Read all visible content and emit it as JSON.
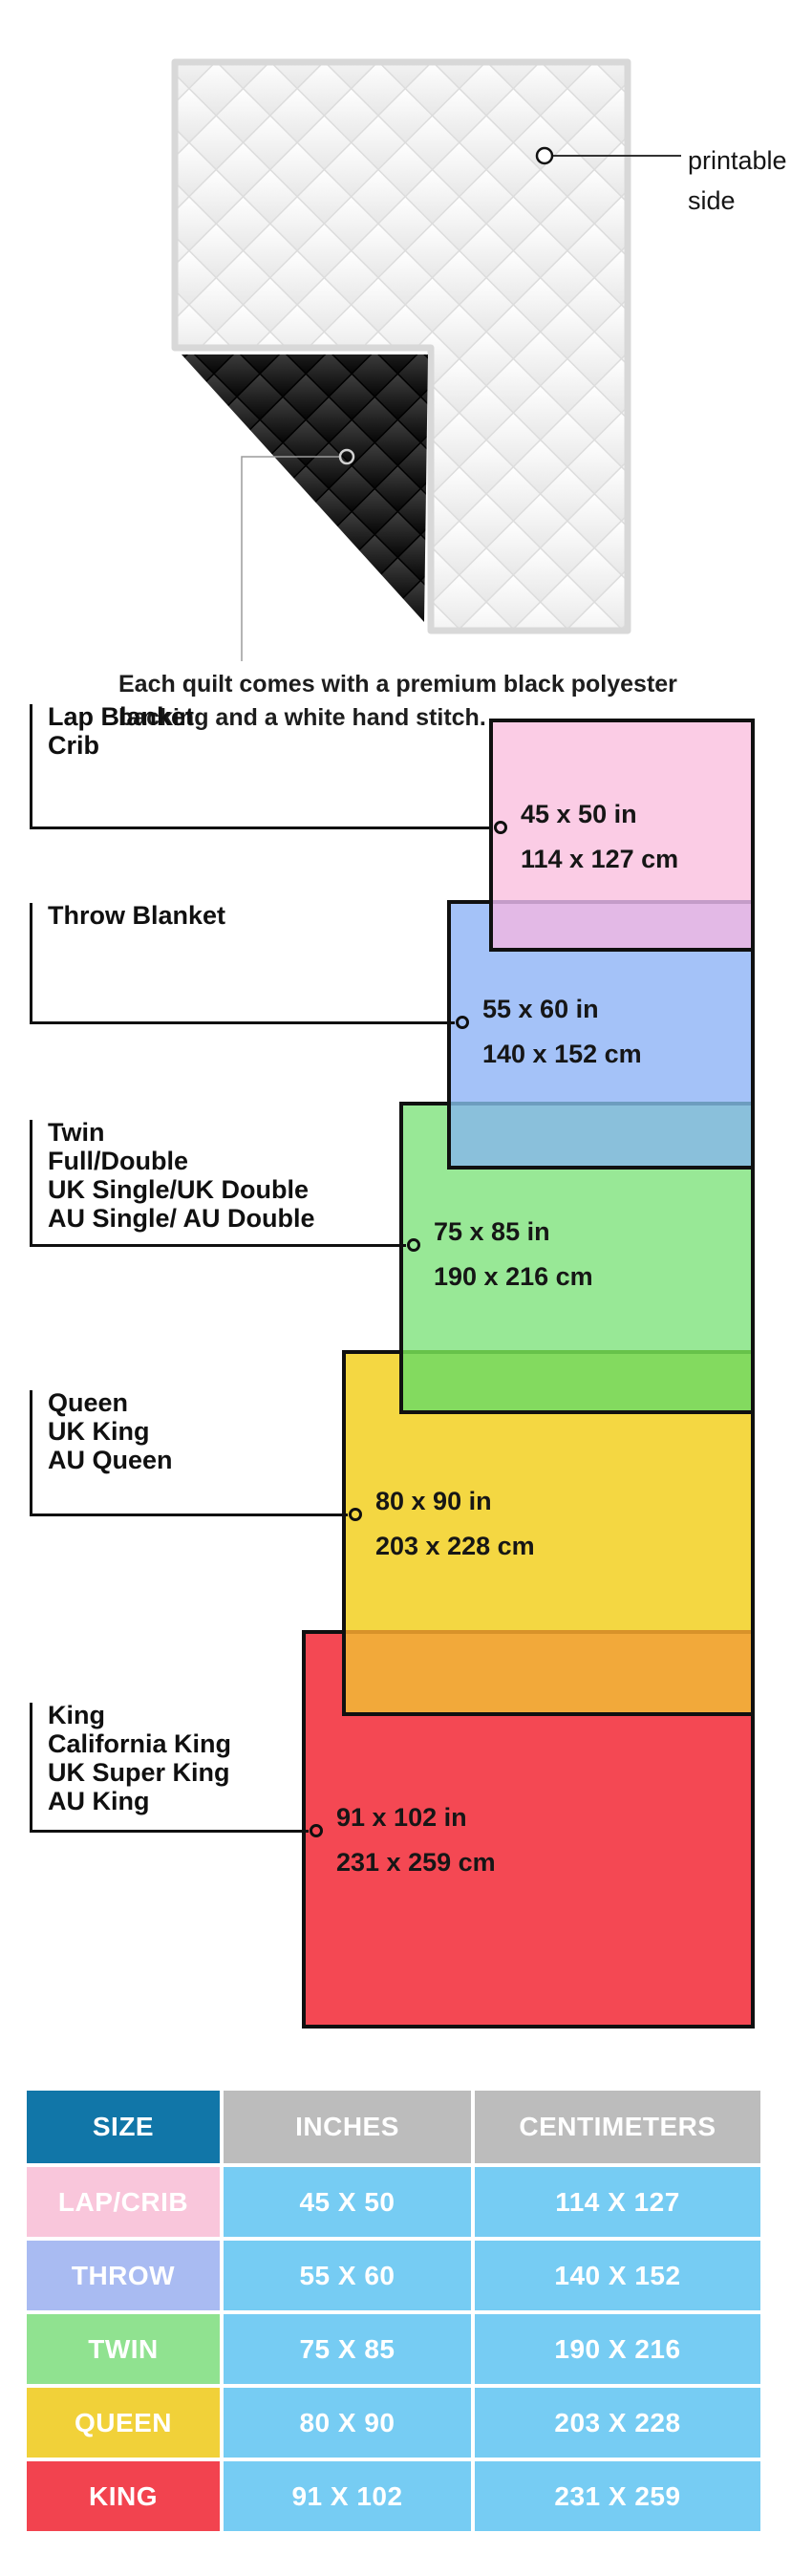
{
  "figure": {
    "printable_label_line1": "printable",
    "printable_label_line2": "side",
    "caption_line1": "Each quilt comes with a premium black polyester",
    "caption_line2": "backing and a white hand stitch."
  },
  "diagram": {
    "sizes": [
      {
        "id": "lap",
        "labels": [
          "Lap Blanket",
          "Crib"
        ],
        "inches": "45 x 50 in",
        "cm": "114 x 127 cm",
        "fill": "#fbcce5",
        "overlap_fill": "#e3b9e6",
        "overlap_line": "#c49cc8"
      },
      {
        "id": "throw",
        "labels": [
          "Throw Blanket"
        ],
        "inches": "55 x 60 in",
        "cm": "140 x 152 cm",
        "fill": "#a4c2f8",
        "overlap_fill": "#8ac0db",
        "overlap_line": "#6d9dbf"
      },
      {
        "id": "twin",
        "labels": [
          "Twin",
          "Full/Double",
          "UK Single/UK Double",
          "AU Single/ AU Double"
        ],
        "inches": "75 x 85 in",
        "cm": "190 x 216 cm",
        "fill": "#98e896",
        "overlap_fill": "#83da5f",
        "overlap_line": "#67c24a"
      },
      {
        "id": "queen",
        "labels": [
          "Queen",
          "UK King",
          "AU Queen"
        ],
        "inches": "80 x 90 in",
        "cm": "203 x 228 cm",
        "fill": "#f4d742",
        "overlap_fill": "#f2a93a",
        "overlap_line": "#d8922a"
      },
      {
        "id": "king",
        "labels": [
          "King",
          "California King",
          "UK Super King",
          "AU King"
        ],
        "inches": "91 x 102 in",
        "cm": "231 x 259 cm",
        "fill": "#f44853",
        "overlap_fill": null,
        "overlap_line": null
      }
    ]
  },
  "table": {
    "headers": [
      "SIZE",
      "INCHES",
      "CENTIMETERS"
    ],
    "header_bg_size": "#1176a8",
    "header_bg_other": "#bcbcbc",
    "cell_bg": "#76ccf3",
    "rows": [
      {
        "size": "LAP/CRIB",
        "inches": "45 X 50",
        "cm": "114 X 127",
        "color": "#f9c6db"
      },
      {
        "size": "THROW",
        "inches": "55 X 60",
        "cm": "140 X 152",
        "color": "#a9bbf2"
      },
      {
        "size": "TWIN",
        "inches": "75 X 85",
        "cm": "190 X 216",
        "color": "#90e290"
      },
      {
        "size": "QUEEN",
        "inches": "80 X 90",
        "cm": "203 X 228",
        "color": "#f1d139"
      },
      {
        "size": "KING",
        "inches": "91 X 102",
        "cm": "231 X 259",
        "color": "#f2434f"
      }
    ]
  }
}
